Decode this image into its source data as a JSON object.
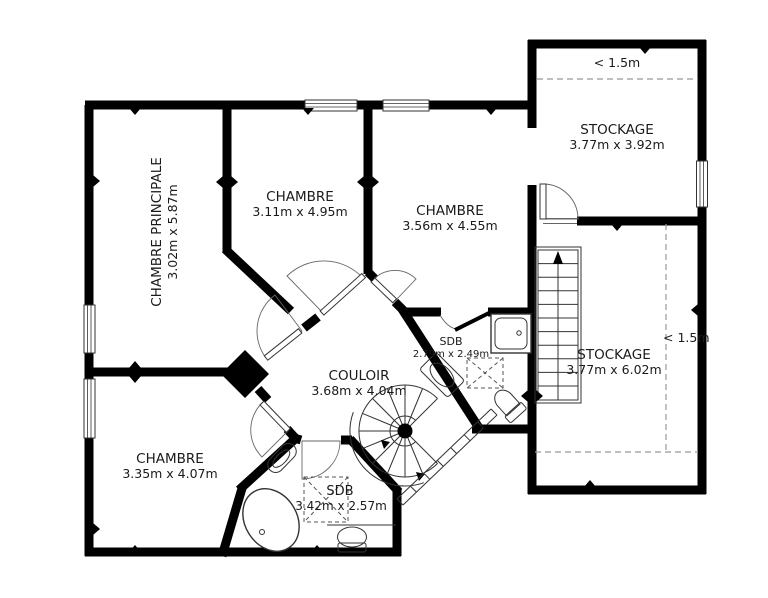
{
  "plan": {
    "title": "floor-plan",
    "rooms": {
      "chambre_principale": {
        "name": "CHAMBRE PRINCIPALE",
        "dims": "3.02m x 5.87m"
      },
      "chambre_nw": {
        "name": "CHAMBRE",
        "dims": "3.11m x 4.95m"
      },
      "chambre_n": {
        "name": "CHAMBRE",
        "dims": "3.56m x 4.55m"
      },
      "chambre_sw": {
        "name": "CHAMBRE",
        "dims": "3.35m x 4.07m"
      },
      "couloir": {
        "name": "COULOIR",
        "dims": "3.68m x 4.04m"
      },
      "sdb_center": {
        "name": "SDB",
        "dims": "2.79m x 2.49m"
      },
      "sdb_south": {
        "name": "SDB",
        "dims": "3.42m x 2.57m"
      },
      "stockage_ne": {
        "name": "STOCKAGE",
        "dims": "3.77m x 3.92m"
      },
      "stockage_e": {
        "name": "STOCKAGE",
        "dims": "3.77m x 6.02m"
      }
    },
    "annotations": {
      "height_limit_top": "< 1.5m",
      "height_limit_right": "< 1.5m"
    },
    "colors": {
      "wall": "#000000",
      "text": "#1a1a1a",
      "dashed_line": "#999999"
    }
  }
}
